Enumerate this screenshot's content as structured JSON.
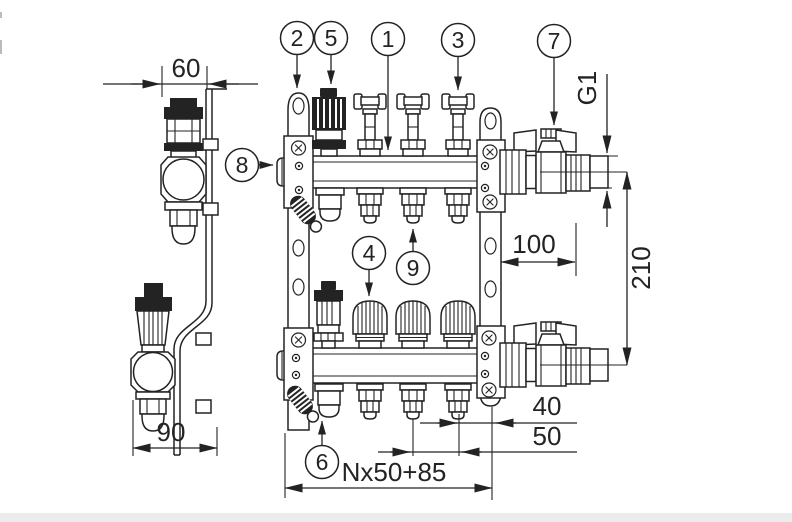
{
  "drawing": {
    "background": "#ffffff",
    "line_color": "#232323",
    "dimensions": {
      "side_width": "60",
      "side_depth": "90",
      "connection_thread": "G1",
      "valve_length": "100",
      "bar_spacing": "210",
      "end_offset": "40",
      "outlet_pitch": "50",
      "total_length": "Nx50+85"
    },
    "callouts": {
      "n1": "1",
      "n2": "2",
      "n3": "3",
      "n4": "4",
      "n5": "5",
      "n6": "6",
      "n7": "7",
      "n8": "8",
      "n9": "9"
    }
  }
}
